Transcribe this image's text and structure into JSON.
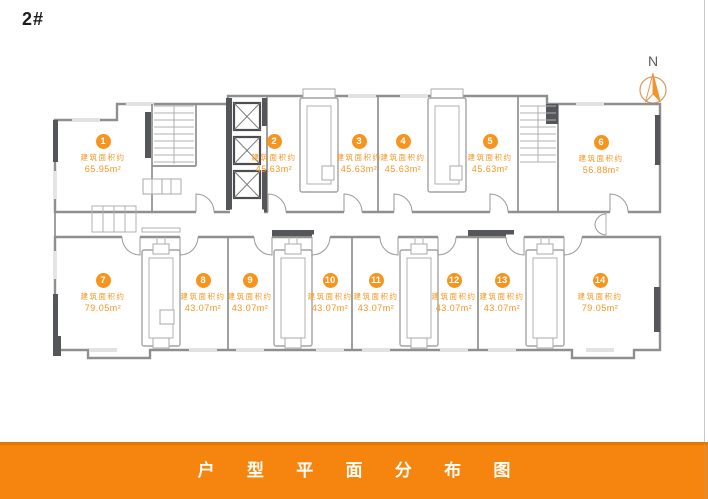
{
  "header": {
    "building_label": "2#"
  },
  "compass": {
    "label": "N"
  },
  "units": [
    {
      "number": "1",
      "area_label": "建筑面积约",
      "area": "65.95m²"
    },
    {
      "number": "2",
      "area_label": "建筑面积约",
      "area": "45.63m²"
    },
    {
      "number": "3",
      "area_label": "建筑面积约",
      "area": "45.63m²"
    },
    {
      "number": "4",
      "area_label": "建筑面积约",
      "area": "45.63m²"
    },
    {
      "number": "5",
      "area_label": "建筑面积约",
      "area": "45.63m²"
    },
    {
      "number": "6",
      "area_label": "建筑面积约",
      "area": "56.88m²"
    },
    {
      "number": "7",
      "area_label": "建筑面积约",
      "area": "79.05m²"
    },
    {
      "number": "8",
      "area_label": "建筑面积约",
      "area": "43.07m²"
    },
    {
      "number": "9",
      "area_label": "建筑面积约",
      "area": "43.07m²"
    },
    {
      "number": "10",
      "area_label": "建筑面积约",
      "area": "43.07m²"
    },
    {
      "number": "11",
      "area_label": "建筑面积约",
      "area": "43.07m²"
    },
    {
      "number": "12",
      "area_label": "建筑面积约",
      "area": "43.07m²"
    },
    {
      "number": "13",
      "area_label": "建筑面积约",
      "area": "43.07m²"
    },
    {
      "number": "14",
      "area_label": "建筑面积约",
      "area": "79.05m²"
    }
  ],
  "footer": {
    "title": "户型平面分布图"
  },
  "colors": {
    "accent": "#F7941E",
    "bar": "#F5850F",
    "wall": "#8F8F8F",
    "wall_thin": "#B0B0B0",
    "wall_dark": "#55565A",
    "door": "#9A9A9A"
  }
}
